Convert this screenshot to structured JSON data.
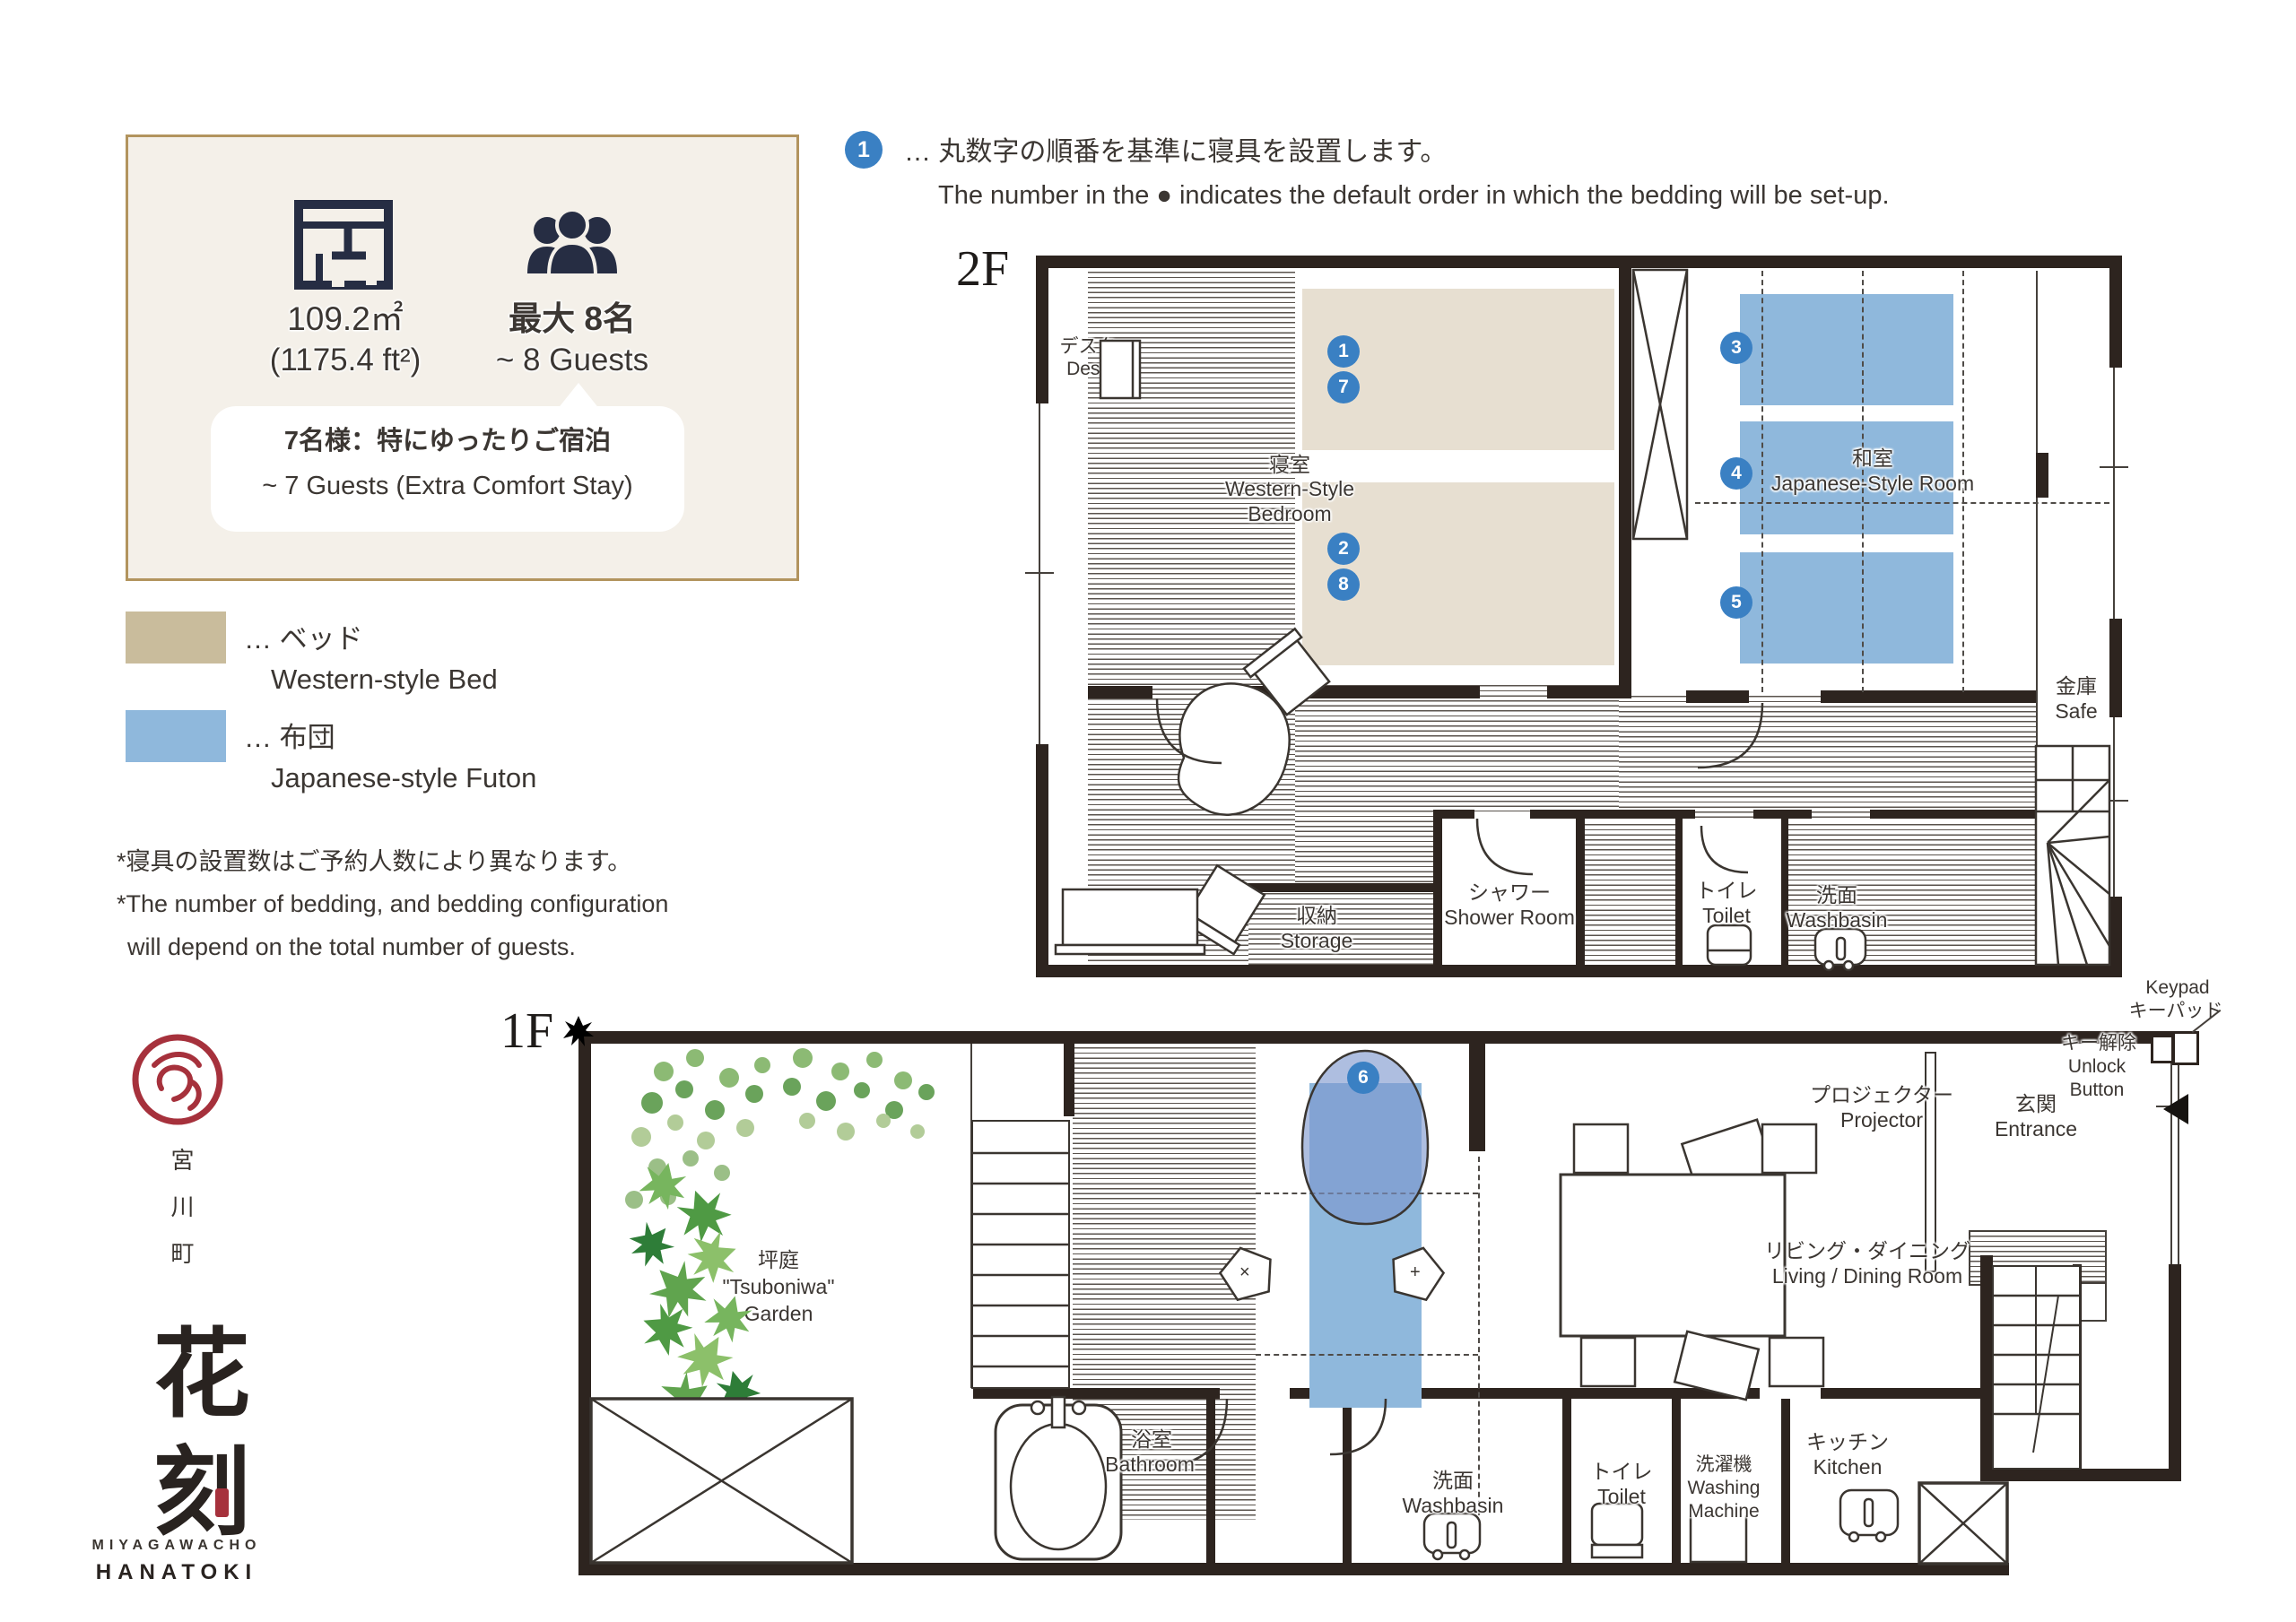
{
  "annotation": {
    "badge": "1",
    "jp": "… 丸数字の順番を基準に寝具を設置します。",
    "en": "The number in the ● indicates the default order in which the bedding will be set-up."
  },
  "info_box": {
    "area_m2": "109.2㎡",
    "area_ft2": "(1175.4 ft²)",
    "capacity_jp": "最大 8名",
    "capacity_en": "~ 8 Guests",
    "bubble_jp": "7名様：特にゆったりご宿泊",
    "bubble_en": "~ 7 Guests (Extra Comfort Stay)"
  },
  "legend": {
    "bed": {
      "jp": "… ベッド",
      "en": "Western-style Bed",
      "color": "#c9bc9c"
    },
    "futon": {
      "jp": "… 布団",
      "en": "Japanese-style Futon",
      "color": "#8fb8dc"
    }
  },
  "notes": {
    "jp": "*寝具の設置数はご予約人数により異なります。",
    "en_line1": "*The number of bedding, and bedding configuration",
    "en_line2": "will depend on the total number of guests."
  },
  "logo": {
    "district_vertical": "宮川町",
    "name_vertical": "花刻",
    "roman_line1": "MIYAGAWACHO",
    "roman_line2": "HANATOKI",
    "emblem_char": "刻"
  },
  "floor2": {
    "label": "2F",
    "rooms": {
      "desk": {
        "jp": "デスク",
        "en": "Desk"
      },
      "bedroom": {
        "jp": "寝室",
        "en1": "Western-Style",
        "en2": "Bedroom"
      },
      "washitsu": {
        "jp": "和室",
        "en": "Japanese-Style Room"
      },
      "safe": {
        "jp": "金庫",
        "en": "Safe"
      },
      "storage": {
        "jp": "収納",
        "en": "Storage"
      },
      "shower": {
        "jp": "シャワー",
        "en": "Shower Room"
      },
      "toilet": {
        "jp": "トイレ",
        "en": "Toilet"
      },
      "washbasin": {
        "jp": "洗面",
        "en": "Washbasin"
      }
    }
  },
  "floor1": {
    "label": "1F",
    "rooms": {
      "garden": {
        "jp": "坪庭",
        "en1": "\"Tsuboniwa\"",
        "en2": "Garden"
      },
      "living": {
        "jp": "リビング・ダイニング",
        "en": "Living / Dining Room"
      },
      "projector": {
        "jp": "プロジェクター",
        "en": "Projector"
      },
      "entrance": {
        "jp": "玄関",
        "en": "Entrance"
      },
      "unlock": {
        "jp": "キー解除",
        "en1": "Unlock",
        "en2": "Button"
      },
      "keypad": {
        "en": "Keypad",
        "jp": "キーパッド"
      },
      "bathroom": {
        "jp": "浴室",
        "en": "Bathroom"
      },
      "washbasin": {
        "jp": "洗面",
        "en": "Washbasin"
      },
      "toilet": {
        "jp": "トイレ",
        "en": "Toilet"
      },
      "washing": {
        "jp": "洗濯機",
        "en1": "Washing",
        "en2": "Machine"
      },
      "kitchen": {
        "jp": "キッチン",
        "en": "Kitchen"
      }
    },
    "cushions": {
      "left_mark": "×",
      "right_mark": "+"
    }
  },
  "badges": [
    "1",
    "7",
    "2",
    "8",
    "3",
    "4",
    "5",
    "6"
  ],
  "colors": {
    "wall": "#2d241f",
    "bed_fill": "#e7dfd1",
    "futon_fill": "#8fb8dc",
    "badge_blue": "#3a80c3",
    "box_bg": "#f4f0e9",
    "box_border": "#b2945e",
    "logo_red": "#a6313c"
  }
}
